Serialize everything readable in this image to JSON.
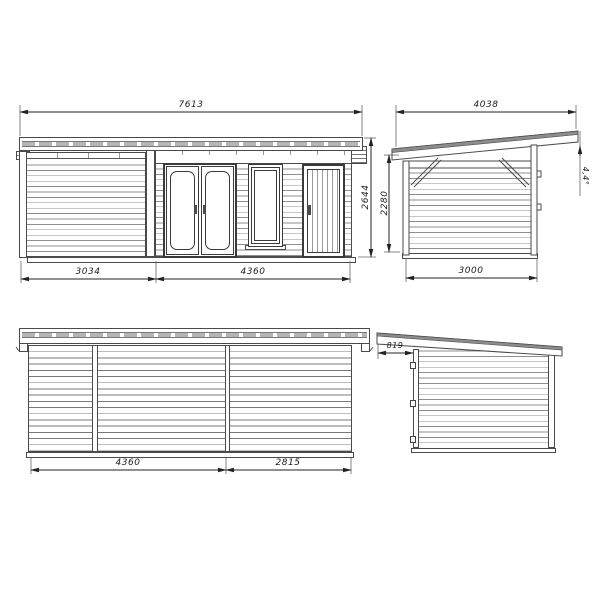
{
  "views": {
    "front_elevation": {
      "dim_roof_width": "7613",
      "dim_porch_width": "3034",
      "dim_cabin_width": "4360",
      "dim_total_height": "2644"
    },
    "side_elevation_right": {
      "dim_roof_length": "4038",
      "dim_wall_height": "2280",
      "dim_wall_length": "3000",
      "roof_angle": "4,4°"
    },
    "rear_elevation": {
      "dim_left_width": "4360",
      "dim_right_width": "2815"
    },
    "side_elevation_left": {
      "dim_roof_overhang": "819"
    }
  }
}
